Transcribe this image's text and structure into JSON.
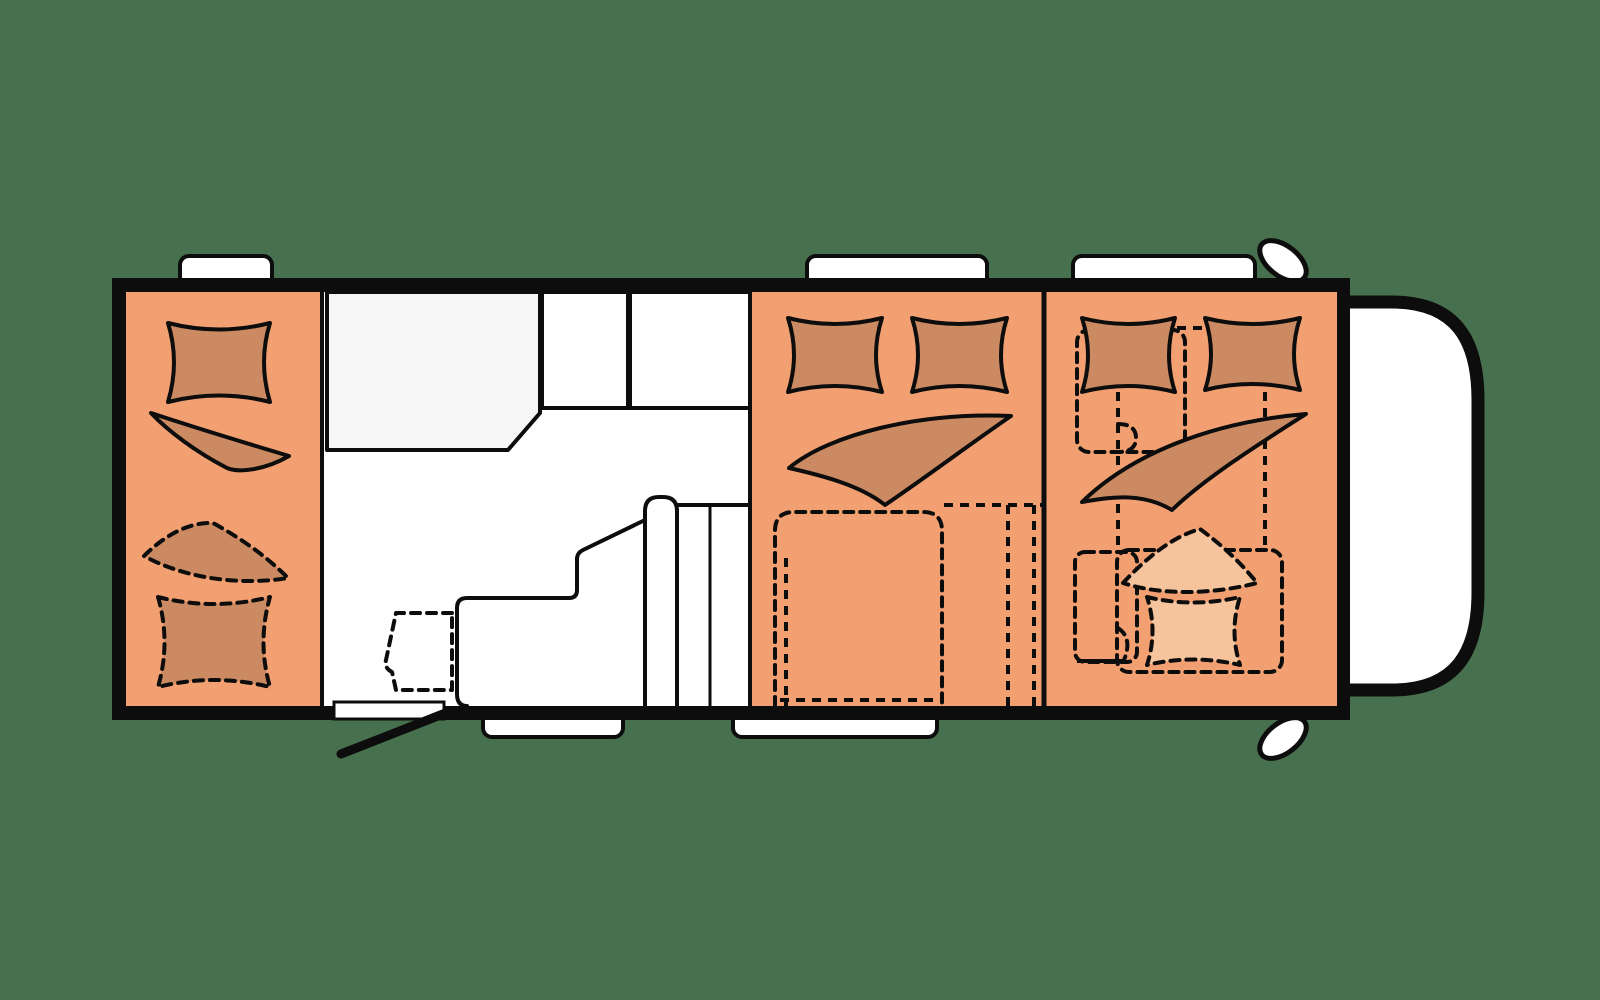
{
  "colors": {
    "background": "#47714E",
    "line": "#0D0D0D",
    "wall": "#0D0D0D",
    "floor": "#FFFFFF",
    "room": "#F2A072",
    "bedding": "#CB8A61",
    "bedding_light": "#F5C49C",
    "washroom": "#F6F6F6",
    "fixture": "#FFFFFF"
  },
  "plan": {
    "type": "motorhome-floor-plan-top-view",
    "rooms": [
      {
        "name": "rear-bedroom",
        "fill": "#F2A072",
        "bedding": "1 solid pillow, 1 solid blanket, 1 dashed pillow, 1 dashed blanket"
      },
      {
        "name": "washroom",
        "fill": "#F6F6F6"
      },
      {
        "name": "living-kitchen",
        "fill": "#FFFFFF",
        "features": [
          "kitchen counter",
          "entry door with swing",
          "dashed cabinet outline",
          "two fixtures"
        ]
      },
      {
        "name": "middle-bedroom",
        "fill": "#F2A072",
        "bedding": "2 solid pillows, 1 solid blanket, dashed convertible-bed outline"
      },
      {
        "name": "front-bedroom",
        "fill": "#F2A072",
        "bedding": "2 solid pillows, 1 solid blanket, 1 light dashed pillow, 1 light dashed blanket, dashed seat outlines"
      },
      {
        "name": "cab-front",
        "fill": "#FFFFFF"
      }
    ],
    "window_count": 3,
    "step_count": 2,
    "mirror_count": 2,
    "door_count": 1
  }
}
